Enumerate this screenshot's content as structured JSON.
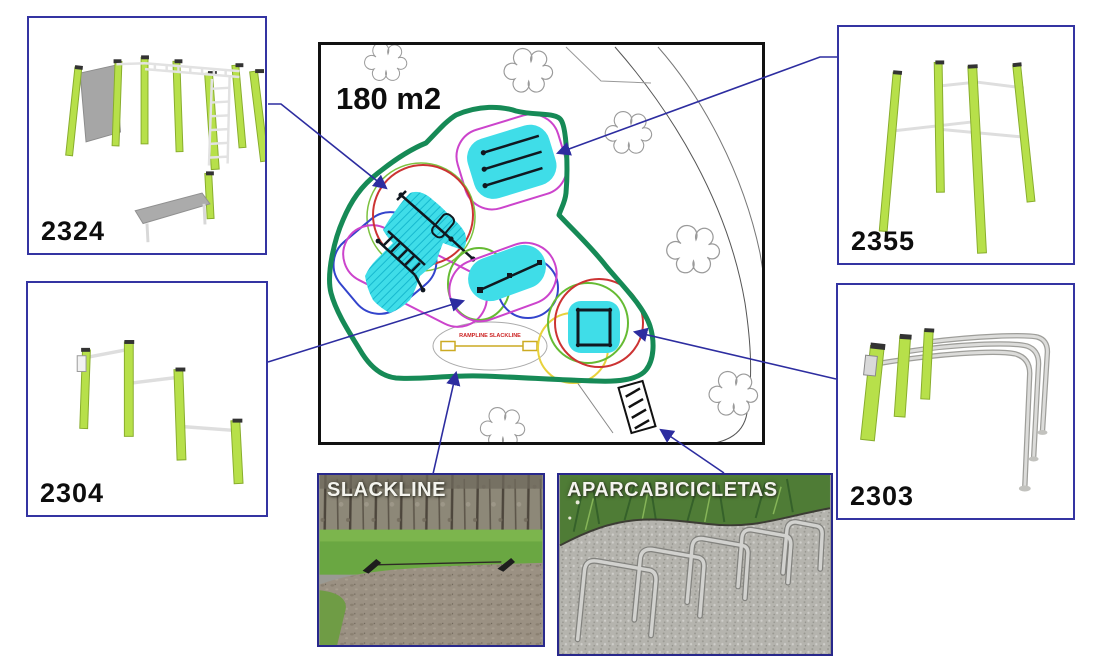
{
  "plan": {
    "area_label": "180 m2",
    "slackline_zone_label": "RAMPLINE SLACKLINE"
  },
  "equipment_boxes": [
    {
      "code": "2324",
      "position": "top-left"
    },
    {
      "code": "2355",
      "position": "top-right"
    },
    {
      "code": "2304",
      "position": "middle-left"
    },
    {
      "code": "2303",
      "position": "middle-right"
    }
  ],
  "photos": [
    {
      "label": "SLACKLINE"
    },
    {
      "label": "APARCABICICLETAS"
    }
  ],
  "colors": {
    "connector_blue": "#2d2da0",
    "zone_outline_green": "#168a56",
    "surface_cyan": "#3fdde8",
    "post_lime": "#b7e04a",
    "safety_red": "#cc3333",
    "safety_magenta": "#cc44cc",
    "safety_blue": "#3344cc",
    "safety_green": "#66bb33",
    "safety_yellow": "#e8d23c",
    "slackline_text_red": "#cc2222"
  }
}
